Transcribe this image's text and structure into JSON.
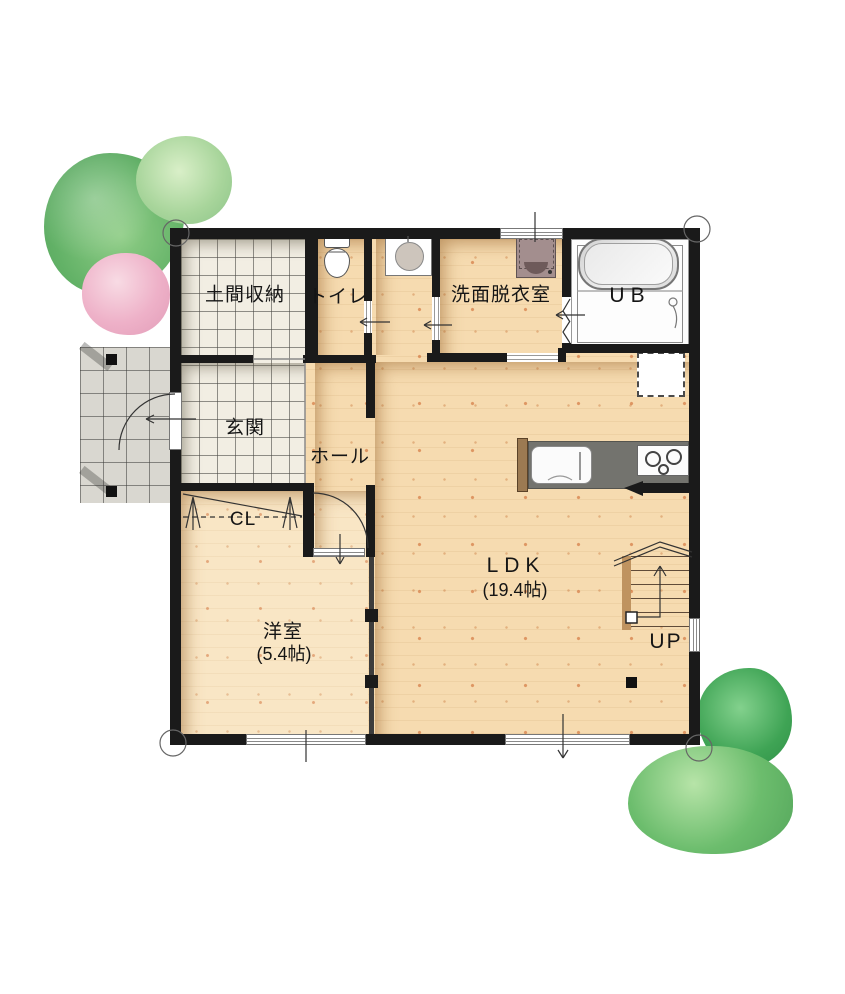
{
  "plan": {
    "rooms": {
      "doma": {
        "label": "土間収納"
      },
      "toilet": {
        "label": "トイレ"
      },
      "washroom": {
        "label": "洗面脱衣室"
      },
      "bath": {
        "label": "UB"
      },
      "genkan": {
        "label": "玄関"
      },
      "hall": {
        "label": "ホール"
      },
      "closet": {
        "label": "CL"
      },
      "western": {
        "label": "洋室",
        "size": "(5.4帖)"
      },
      "ldk": {
        "label": "LDK",
        "size": "(19.4帖)"
      },
      "stairs": {
        "label": "UP"
      }
    },
    "icons": [
      "toilet-icon",
      "washbasin-icon",
      "washing-machine-icon",
      "bathtub-icon",
      "shower-icon",
      "kitchen-sink-icon",
      "stove-icon",
      "refrigerator-outline-icon",
      "stairs-icon",
      "closet-hanger-icon",
      "door-swing-icon",
      "sliding-door-arrow-icon",
      "folding-door-icon",
      "tree-icon",
      "porch-tiles-icon"
    ],
    "colors": {
      "wall": "#1a1a1a",
      "wood_floor": "#f6dbb0",
      "western_floor": "#f9e6c5",
      "tile_floor": "#f2eee3",
      "porch_tile": "#d9d7d0",
      "kitchen_counter": "#73736e",
      "washer": "#a38e8e",
      "tree_green": "#63b267",
      "tree_light_green": "#a8d59b",
      "tree_pink": "#eeb1c8",
      "tree_dark_green": "#3fa455",
      "tree_round_green": "#6cbd6d"
    }
  }
}
